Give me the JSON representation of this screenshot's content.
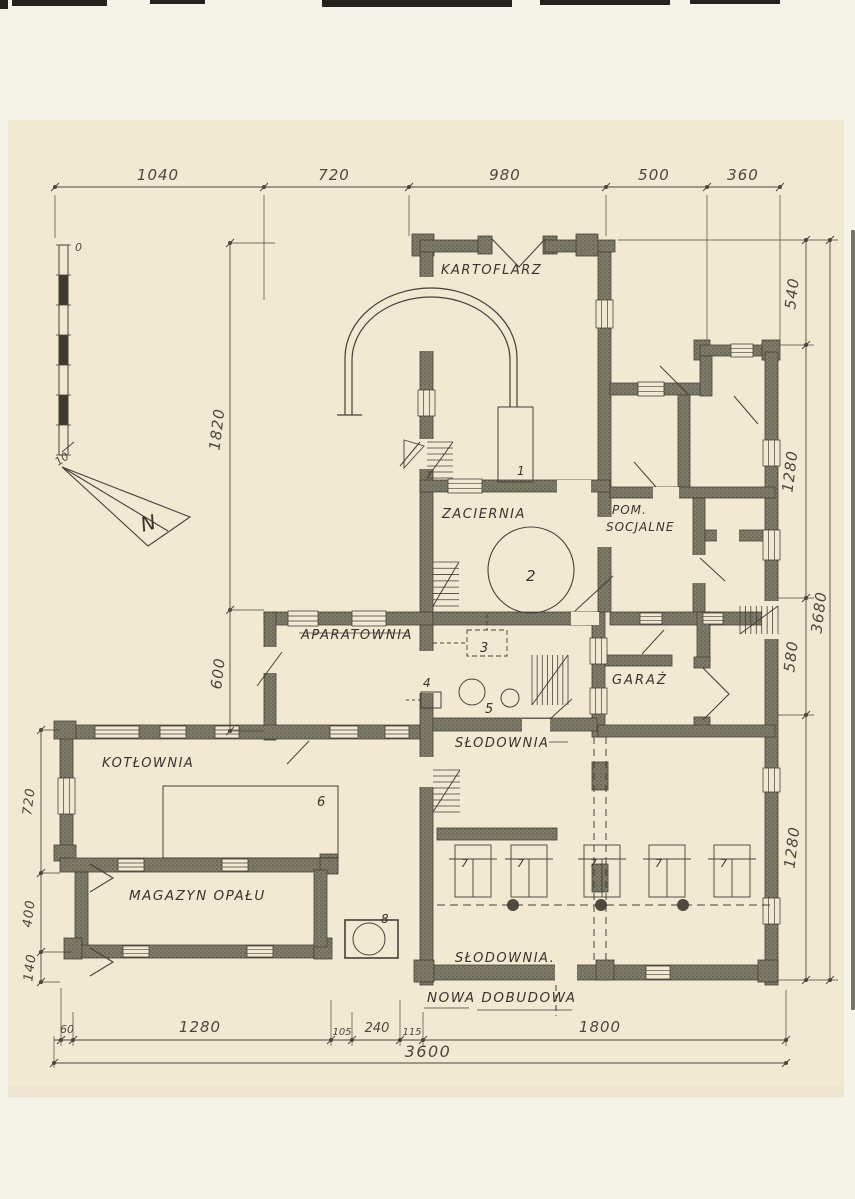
{
  "plan": {
    "rooms": {
      "kartoflarz": "KARTOFLARZ",
      "zaciernia": "ZACIERNIA",
      "pom1": "POM.",
      "pom2": "SOCJALNE",
      "aparatownia": "APARATOWNIA",
      "garaz": "GARAŻ",
      "slodownia": "SŁODOWNIA",
      "kotlownia": "KOTŁOWNIA",
      "magazyn": "MAGAZYN OPAŁU",
      "slodownia2": "SŁODOWNIA.",
      "nowa": "NOWA DOBUDOWA"
    },
    "items": {
      "i1": "1",
      "i2": "2",
      "i3": "3",
      "i4": "4",
      "i5": "5",
      "i6": "6",
      "i8": "8",
      "rack": "7"
    },
    "dims": {
      "top": [
        "1040",
        "720",
        "980",
        "500",
        "360"
      ],
      "right": [
        "540",
        "1280",
        "580",
        "1280"
      ],
      "right_total": "3680",
      "left": [
        "1820",
        "600"
      ],
      "left_lower": [
        "720",
        "400",
        "140"
      ],
      "bottom": [
        "60",
        "1280",
        "105",
        "240",
        "115",
        "1800"
      ],
      "bottom_total": "3600"
    },
    "scalebar": {
      "zero": "0",
      "ten": "10"
    },
    "north": {
      "label": "N"
    },
    "colors": {
      "paper": "#f2e9d3",
      "backing": "#f5f2e7",
      "ink": "#45413a",
      "wall_fill": "#807c6a",
      "dim_ink": "#4c463d"
    }
  }
}
